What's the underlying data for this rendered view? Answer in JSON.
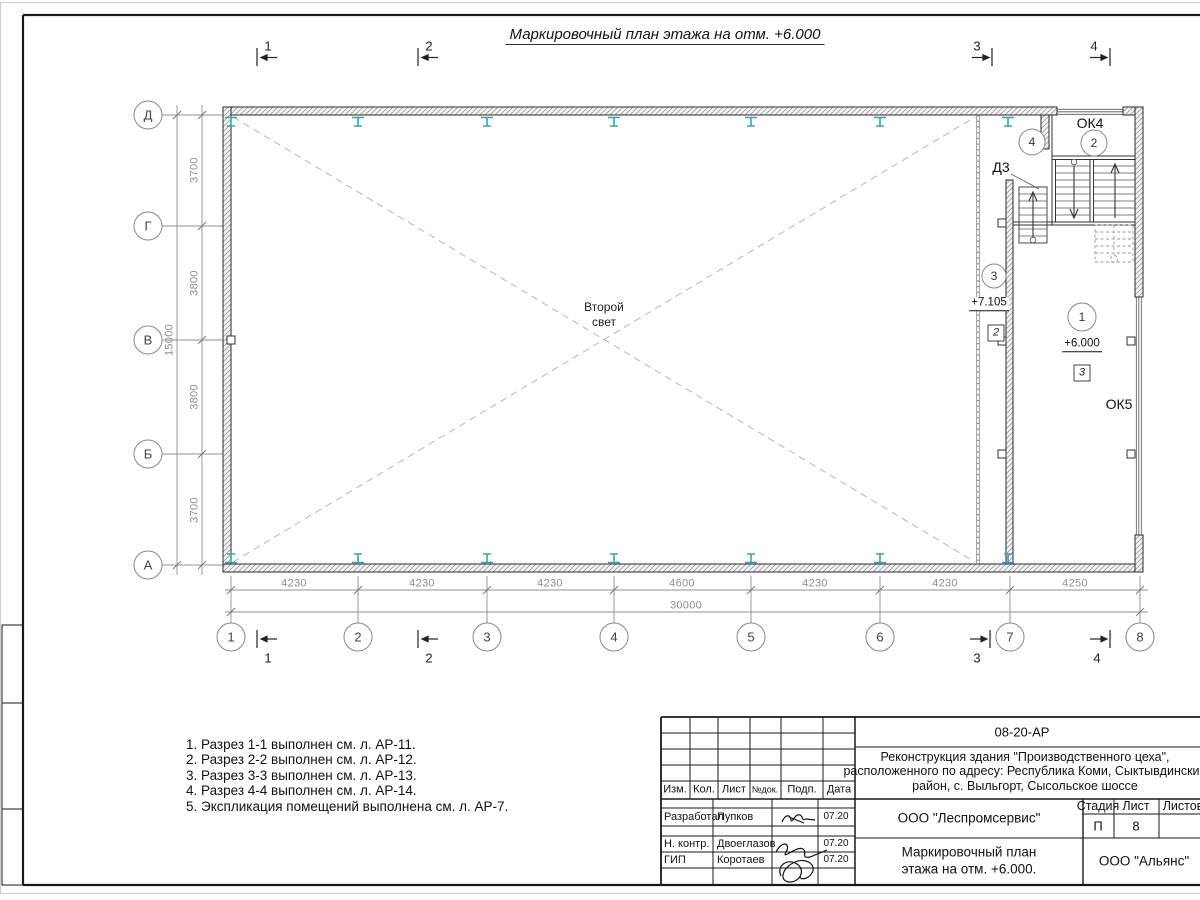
{
  "title": "Маркировочный план этажа на отм. +6.000",
  "plan": {
    "axes_rows": [
      "Д",
      "Г",
      "В",
      "Б",
      "А"
    ],
    "axes_cols": [
      "1",
      "2",
      "3",
      "4",
      "5",
      "6",
      "7",
      "8"
    ],
    "dims_left": [
      "3700",
      "3800",
      "3800",
      "3700"
    ],
    "dim_left_total": "15000",
    "dims_bottom": [
      "4230",
      "4230",
      "4230",
      "4600",
      "4230",
      "4230",
      "4250"
    ],
    "dim_bottom_total": "30000",
    "sections": [
      "1",
      "2",
      "3",
      "4"
    ],
    "labels": {
      "second_light_line1": "Второй",
      "second_light_line2": "свет",
      "ok4": "ОК4",
      "ok5": "ОК5",
      "d3": "Д3",
      "room_1": "1",
      "room_2": "2",
      "room_3": "3",
      "room_4": "4",
      "elev_upper": "+7.105",
      "elev_main": "+6.000",
      "node_2": "2",
      "node_3": "3"
    }
  },
  "notes": [
    "1. Разрез 1-1 выполнен см. л. АР-11.",
    "2. Разрез 2-2 выполнен см. л. АР-12.",
    "3. Разрез 3-3 выполнен см. л. АР-13.",
    "4. Разрез 4-4 выполнен см. л. АР-14.",
    "5. Экспликация помещений выполнена см. л. АР-7."
  ],
  "titleblock": {
    "code": "08-20-АР",
    "project_line1": "Реконструкция здания \"Производственного цеха\",",
    "project_line2": "расположенного по адресу: Республика Коми, Сыктывдинский",
    "project_line3": "район, с. Выльгорт, Сысольское шоссе",
    "col_izm": "Изм.",
    "col_kol": "Кол.",
    "col_list": "Лист",
    "col_ndok": "№док.",
    "col_podp": "Подп.",
    "col_data": "Дата",
    "row_developed_label": "Разработал",
    "row_developed_name": "Пупков",
    "row_developed_date": "07.20",
    "row_ncontrol_label": "Н. контр.",
    "row_ncontrol_name": "Двоеглазов",
    "row_ncontrol_date": "07.20",
    "row_gip_label": "ГИП",
    "row_gip_name": "Коротаев",
    "row_gip_date": "07.20",
    "org_designer": "ООО \"Леспромсервис\"",
    "doc_title_line1": "Маркировочный план",
    "doc_title_line2": "этажа на отм. +6.000.",
    "stage_label": "Стадия",
    "sheet_label": "Лист",
    "sheets_label": "Листов",
    "stage_value": "П",
    "sheet_value": "8",
    "org_client": "ООО \"Альянс\""
  },
  "colors": {
    "beam_teal": "#3aa3ab",
    "dim_gray": "#909090",
    "wall_line": "#2a2a2a"
  }
}
